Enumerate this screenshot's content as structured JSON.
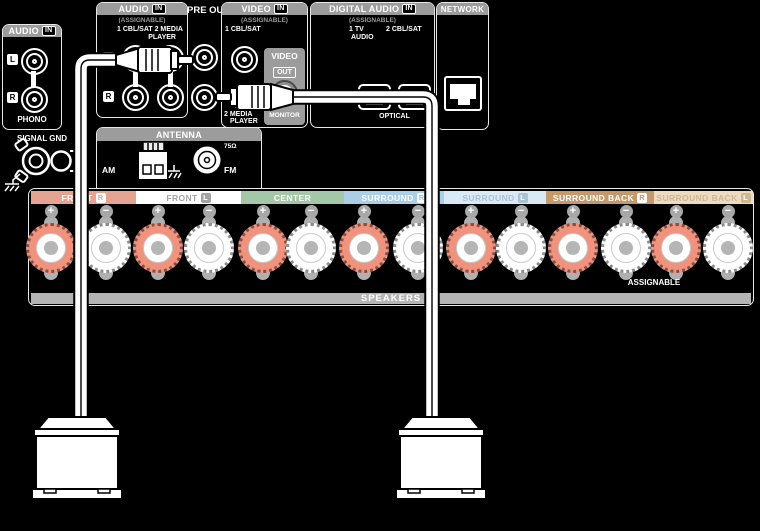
{
  "sections": {
    "audio_in_phono": {
      "title": "AUDIO",
      "badge": "IN",
      "channel_l": "L",
      "channel_r": "R",
      "caption": "PHONO"
    },
    "audio_in_assignable": {
      "title": "AUDIO",
      "badge": "IN",
      "subtitle": "(ASSIGNABLE)",
      "jacks_line1": "1 CBL/SAT 2 MEDIA",
      "jacks_line2": "PLAYER",
      "channel_l": "L",
      "channel_r": "R"
    },
    "pre_out": {
      "title": "PRE OUT"
    },
    "video_in": {
      "title": "VIDEO",
      "badge": "IN",
      "subtitle": "(ASSIGNABLE)",
      "jack1_label": "1 CBL/SAT",
      "jack2_line1": "2 MEDIA",
      "jack2_line2": "PLAYER",
      "video_out": {
        "title": "VIDEO",
        "badge": "OUT",
        "jack_label": "MONITOR"
      }
    },
    "digital_audio_in": {
      "title": "DIGITAL AUDIO",
      "badge": "IN",
      "subtitle": "(ASSIGNABLE)",
      "jack1_line1": "1  TV",
      "jack1_line2": "AUDIO",
      "jack2_label": "2 CBL/SAT",
      "caption": "OPTICAL"
    },
    "network": {
      "title": "NETWORK"
    },
    "signal_gnd": {
      "label": "SIGNAL GND"
    },
    "antenna": {
      "title": "ANTENNA",
      "am_label": "AM",
      "fm_label": "FM",
      "impedance": "75Ω"
    },
    "speakers": {
      "caption": "SPEAKERS",
      "assignable": "ASSIGNABLE",
      "plus": "+",
      "minus": "−",
      "terminal_colors": {
        "positive": "#f0937e",
        "negative": "#ffffff"
      },
      "channels": [
        {
          "label": "FRONT",
          "badge": "R",
          "bg": "#e5a492",
          "fg": "#ffffff",
          "badge_bg": "#ffffff",
          "badge_fg": "#e5a492"
        },
        {
          "label": "FRONT",
          "badge": "L",
          "bg": "#ffffff",
          "fg": "#a3a3a3",
          "badge_bg": "#a3a3a3",
          "badge_fg": "#ffffff"
        },
        {
          "label": "CENTER",
          "badge": null,
          "bg": "#a4c7a8",
          "fg": "#ffffff",
          "badge_bg": null,
          "badge_fg": null
        },
        {
          "label": "SURROUND",
          "badge": "R",
          "bg": "#aacfe6",
          "fg": "#ffffff",
          "badge_bg": "#ffffff",
          "badge_fg": "#93c3de"
        },
        {
          "label": "SURROUND",
          "badge": "L",
          "bg": "#d9eaf4",
          "fg": "#aac3d2",
          "badge_bg": "#aac3d2",
          "badge_fg": "#ffffff"
        },
        {
          "label": "SURROUND BACK",
          "badge": "R",
          "bg": "#c49a6c",
          "fg": "#ffffff",
          "badge_bg": "#ffffff",
          "badge_fg": "#c49a6c"
        },
        {
          "label": "SURROUND BACK",
          "badge": "L",
          "bg": "#ecdbc1",
          "fg": "#cdb795",
          "badge_bg": "#cdb795",
          "badge_fg": "#ffffff"
        }
      ]
    }
  }
}
